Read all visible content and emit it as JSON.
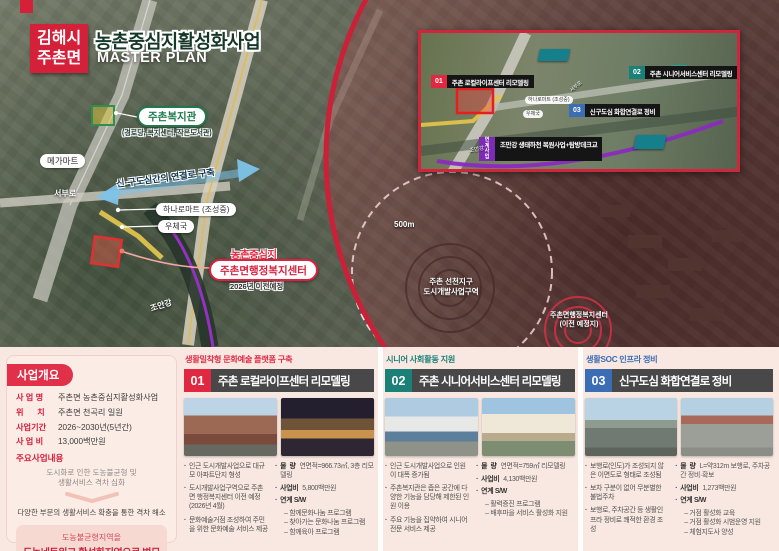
{
  "header": {
    "badge_line1": "김해시",
    "badge_line2": "주촌면",
    "title": "농촌중심지활성화사업",
    "subtitle": "MASTER PLAN"
  },
  "colors": {
    "accent_red": "#d5203a",
    "teal": "#1a8078",
    "blue": "#3a6db4",
    "purple": "#8a2bbf",
    "title_dark": "#484848",
    "pink_bg": "#f9e8e1"
  },
  "map": {
    "megamart": "메가마트",
    "seobu_ro": "서부로",
    "welfare_center": "주촌복지관",
    "welfare_center_sub": "(경로당, 복지센터, 작은도서관)",
    "connection_road": "신·구도심간의 연결로 구축",
    "hanaro": "하나로마트 (조성중)",
    "post_office": "우체국",
    "rural_center": "농촌중심지",
    "admin_center": "주촌면행정복지센터",
    "admin_center_note": "2026년 이전예정",
    "radius": "500m",
    "district_line1": "주촌 선천지구",
    "district_line2": "도시개발사업구역",
    "relocation_line1": "주촌면행정복지센터",
    "relocation_line2": "(이전 예정지)",
    "joman_river": "조안강"
  },
  "inset": {
    "items": [
      {
        "no": "01",
        "label": "주촌 로컬라이프센터 리모델링"
      },
      {
        "no": "02",
        "label": "주촌 시니어서비스센터 리모델링"
      },
      {
        "no": "03",
        "label": "신구도심 화합연결로 정비"
      }
    ],
    "linked_badge": "연계 사업",
    "linked_label": "조만강 생태하천 복원사업+탐방데크교",
    "small": {
      "hanaro": "하나로마트 (조성중)",
      "post": "우체국",
      "road": "서부로",
      "river": "조만강"
    }
  },
  "overview": {
    "title": "사업개요",
    "fields": [
      {
        "label": "사 업 명",
        "value": "주촌면 농촌중심지활성화사업"
      },
      {
        "label": "위      치",
        "value": "주촌면 천곡리 일원"
      },
      {
        "label": "사업기간",
        "value": "2026~2030년(5년간)"
      },
      {
        "label": "사 업 비",
        "value": "13,000백만원"
      }
    ],
    "subtitle": "주요사업내용",
    "problem1": "도시화로 인한 도농불균형 및",
    "problem2": "생활서비스 격차 심화",
    "solution": "다양한 부문의 생활서비스 확충을 통한 격차 해소",
    "goal1": "도농불균형지역을",
    "goal2": "도농네트워크 활성화지역으로 변모"
  },
  "projects": [
    {
      "no": "01",
      "category": "생활밀착형 문화예술 플랫폼 구축",
      "title": "주촌 로컬라이프센터 리모델링",
      "issues": [
        "인근 도시개발사업으로 대규모 아파트단지 형성",
        "도시개발사업구역으로 주촌면 행정복지센터 이전 예정 (2026년 4월)",
        "문화예술거점 조성하여 주민을 위한 문화예술 서비스 제공"
      ],
      "qty_label": "물  량",
      "qty": "연면적=966.73㎡, 3층 리모델링",
      "cost_label": "사업비",
      "cost": "5,800백만원",
      "sw_label": "연계 S/W",
      "sw": [
        "함께문화나눔 프로그램",
        "찾아가는 문화나눔 프로그램",
        "함께육아 프로그램"
      ]
    },
    {
      "no": "02",
      "category": "시니어 사회활동 지원",
      "title": "주촌 시니어서비스센터 리모델링",
      "issues": [
        "인근 도시개발사업으로 인원이 대폭 증가됨",
        "주촌복지관은 좁은 공간에 다양한 기능을 담당해 제한된 인원 이용",
        "주요 기능을 집약하여 시니어 전문 서비스 제공"
      ],
      "qty_label": "물  량",
      "qty": "연면적=759㎡ 리모델링",
      "cost_label": "사업비",
      "cost": "4,130백만원",
      "sw_label": "연계 S/W",
      "sw": [
        "활력증진 프로그램",
        "배후마을 서비스 활성화 지원"
      ]
    },
    {
      "no": "03",
      "category": "생활SOC 인프라 정비",
      "title": "신구도심 화합연결로 정비",
      "issues": [
        "보행로(인도)가 조성되지 않은 이면도로 형태로 조성됨",
        "보차 구분이 없어 무분별한 불법주차",
        "보행로, 주차공간 등 생활인프라 정비로 쾌적한 환경 조성"
      ],
      "qty_label": "물  량",
      "qty": "L=약312m 보행로, 주차공간 정비·확보",
      "cost_label": "사업비",
      "cost": "1,273백만원",
      "sw_label": "연계 S/W",
      "sw": [
        "거점 활성화 교육",
        "거점 활성화 시범운영 지원",
        "체험지도사 양성"
      ]
    }
  ]
}
